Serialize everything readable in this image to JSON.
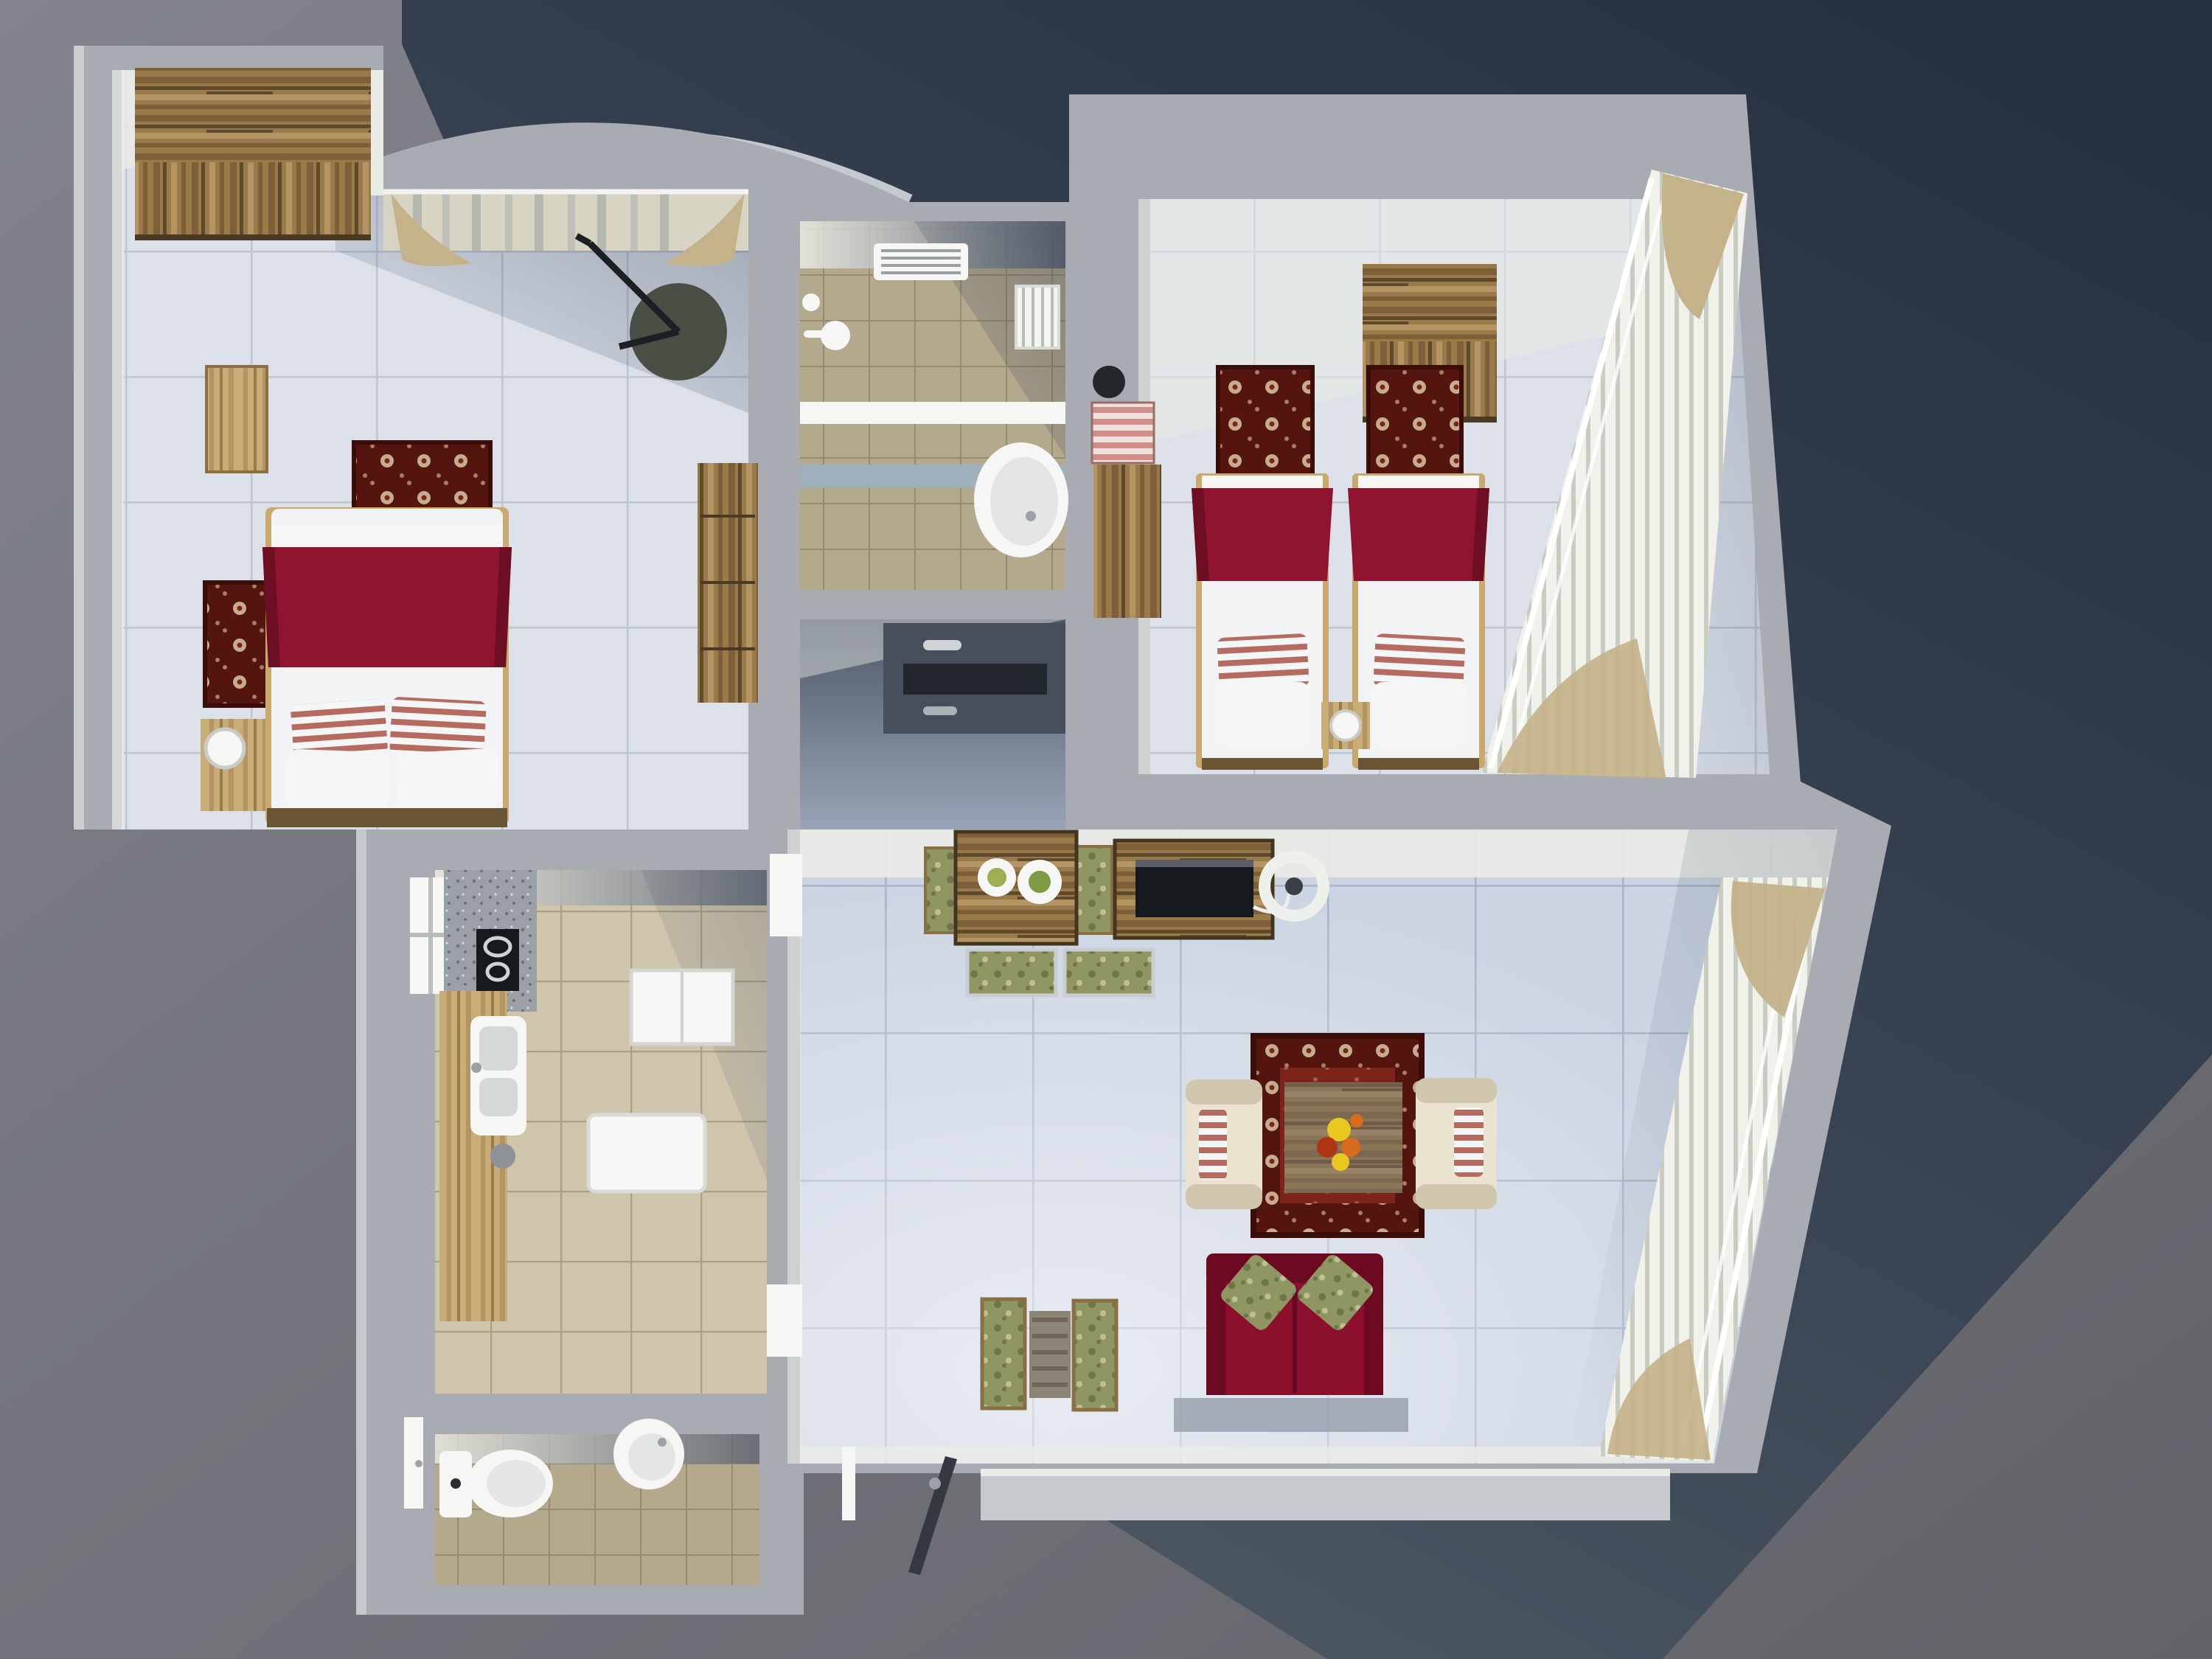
{
  "palette": {
    "bg_top": "#82838b",
    "bg_bottom": "#626369",
    "shadow_dark": "#27313f",
    "shadow_mid": "#3b4553",
    "shadow_light": "#525b67",
    "wall": "#a8abb1",
    "wall_lit": "#e9ebe5",
    "wall_face_dark": "#596170",
    "floor_bed": "#dbe0e9",
    "grout_bed": "#bdc4d2",
    "floor_living": "#ccd4e2",
    "grout_living": "#a9b4c6",
    "floor_tan": "#b4a88d",
    "grout_tan": "#978b6f",
    "floor_kitchen": "#cfc5ad",
    "grout_kitchen": "#ab9f82",
    "hall_dark": "#55master",
    "hall_top": "#4e5866",
    "hall_bottom": "#98a3b5",
    "wood_dark1": "#5f4a2e",
    "wood_dark2": "#7d5f3a",
    "wood_mid": "#9a7a48",
    "wood_light1": "#c9ad77",
    "wood_light2": "#b59463",
    "bed_red": "#8e1430",
    "bed_red_dark": "#6d0e25",
    "mattress": "#f1f3f5",
    "pillow_stripe_red": "#b56b60",
    "pillow_white": "#f4f5f7",
    "rug_border": "#54150f",
    "rug_field": "#7c241c",
    "rug_cream": "#d8c7a4",
    "cream_chair": "#e9e3cf",
    "cream_shadow": "#cfc6ad",
    "sofa_red": "#8c0f2e",
    "sofa_red_dark": "#6b0a22",
    "pillow_green": "#9ba065",
    "pillow_green_dark": "#7c8150",
    "blind": "#f0f1ea",
    "blind_shadow": "#c9ccc0",
    "curtain_tan": "#c3b28a",
    "white": "#f6f7f5",
    "chrome": "#9aa2a8",
    "dark": "#22262d",
    "radiator": "#f3f5f1",
    "speckle_bg": "#9aa0a6",
    "speckle_dot": "#6c7278",
    "tv_black": "#15181d",
    "door_dark": "#343941",
    "mat_gray": "#949daa",
    "porch": "#c6cacf",
    "green_fab": "#8f9663",
    "green_fab_dark": "#6f7547",
    "flame_orange": "#d96b1e",
    "flame_yellow": "#e8c81f",
    "flame_red": "#b03414"
  },
  "scene": {
    "type": "3d-apartment-floor-plan-render",
    "rooms": [
      {
        "name": "bedroom-1",
        "furniture": [
          "wardrobe",
          "double-bed",
          "nightstand",
          "table-lamp",
          "floor-lamp",
          "dresser",
          "floral-rug",
          "floral-rug",
          "curtained-window",
          "curved-balcony"
        ]
      },
      {
        "name": "bathroom",
        "furniture": [
          "shower-head",
          "radiator",
          "washbasin",
          "wall-vent",
          "partition-shelf"
        ]
      },
      {
        "name": "hallway",
        "furniture": [
          "built-in-wardrobe"
        ]
      },
      {
        "name": "bedroom-2",
        "furniture": [
          "wardrobe",
          "single-bed",
          "single-bed",
          "nightstand",
          "dresser",
          "striped-laundry-basket",
          "ball-lamp",
          "floral-rug",
          "floral-rug",
          "vertical-blinds",
          "tied-curtains"
        ]
      },
      {
        "name": "kitchen",
        "furniture": [
          "cooktop",
          "double-sink",
          "counter",
          "speckled-worktop",
          "fridge",
          "washing-machine",
          "trash-bin",
          "window"
        ]
      },
      {
        "name": "wc",
        "furniture": [
          "toilet",
          "round-washbasin",
          "door"
        ]
      },
      {
        "name": "living-room",
        "furniture": [
          "dining-table",
          "dining-chairs",
          "tv-console",
          "tv",
          "round-fan",
          "coffee-table",
          "floral-area-rug",
          "armchair-left",
          "armchair-right",
          "red-sofa",
          "green-pillows",
          "side-chairs",
          "side-table",
          "door-left-wall",
          "open-glass-door",
          "slanted-balcony-blinds",
          "terrace-step",
          "doormat"
        ]
      }
    ]
  }
}
